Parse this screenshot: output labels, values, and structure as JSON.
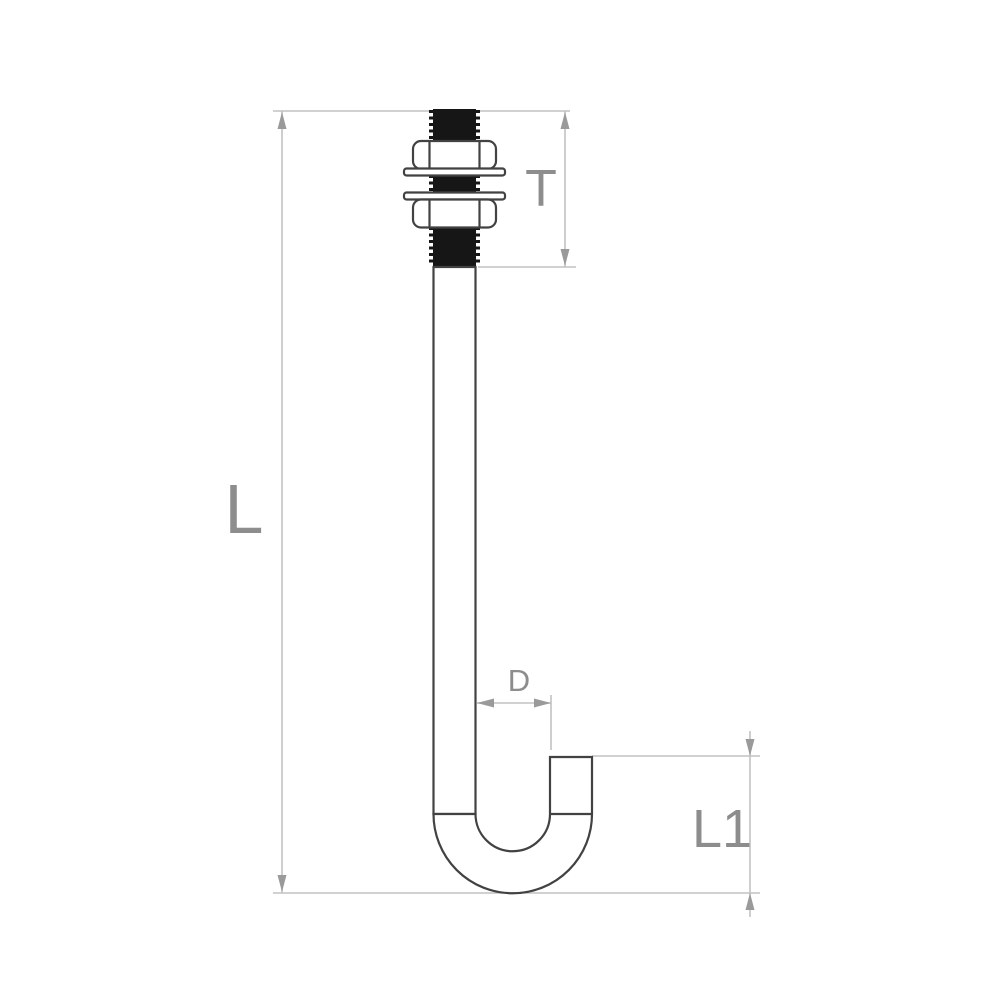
{
  "diagram": {
    "dimensions": {
      "total_length_label": "L",
      "thread_length_label": "T",
      "rod_diameter_label": "D",
      "hook_length_label": "L1"
    },
    "colors": {
      "background": "#ffffff",
      "outline": "#424242",
      "thread": "#161616",
      "dim_line": "#c2c2c2",
      "arrow": "#9a9a9a",
      "label": "#8d8d8d"
    }
  }
}
